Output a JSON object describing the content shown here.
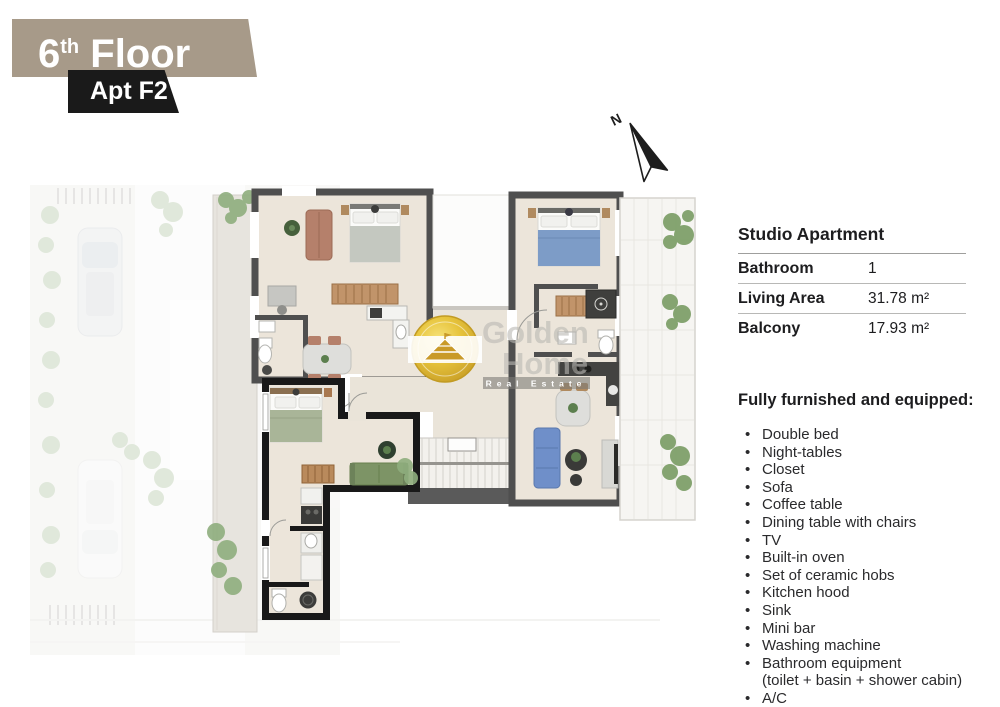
{
  "header": {
    "floor_number": "6",
    "floor_suffix": "th",
    "floor_word": " Floor",
    "apt_label": "Apt F2"
  },
  "compass": {
    "label": "N"
  },
  "specs": {
    "title": "Studio Apartment",
    "rows": [
      {
        "label": "Bathroom",
        "value": "1"
      },
      {
        "label": "Living Area",
        "value": "31.78 m²"
      },
      {
        "label": "Balcony",
        "value": "17.93 m²"
      }
    ]
  },
  "features": {
    "heading": "Fully furnished and equipped:",
    "items": [
      "Double bed",
      "Night-tables",
      "Closet",
      "Sofa",
      "Coffee table",
      "Dining table with chairs",
      "TV",
      "Built-in oven",
      "Set of ceramic hobs",
      "Kitchen hood",
      "Sink",
      "Mini bar",
      "Washing machine",
      "Bathroom equipment",
      "(toilet + basin + shower cabin)",
      "A/C"
    ]
  },
  "watermark": {
    "line1": "Golden",
    "line2": "Home",
    "line3": "Real Estate"
  },
  "colors": {
    "banner_taupe": "#a79a89",
    "banner_black": "#1a1a1a",
    "wall_gray": "#4f4f4f",
    "wall_highlight": "#191919",
    "floor_beige": "#ece5da",
    "logo_gold": "#e7c43c",
    "greenery": "#8fae7e"
  }
}
